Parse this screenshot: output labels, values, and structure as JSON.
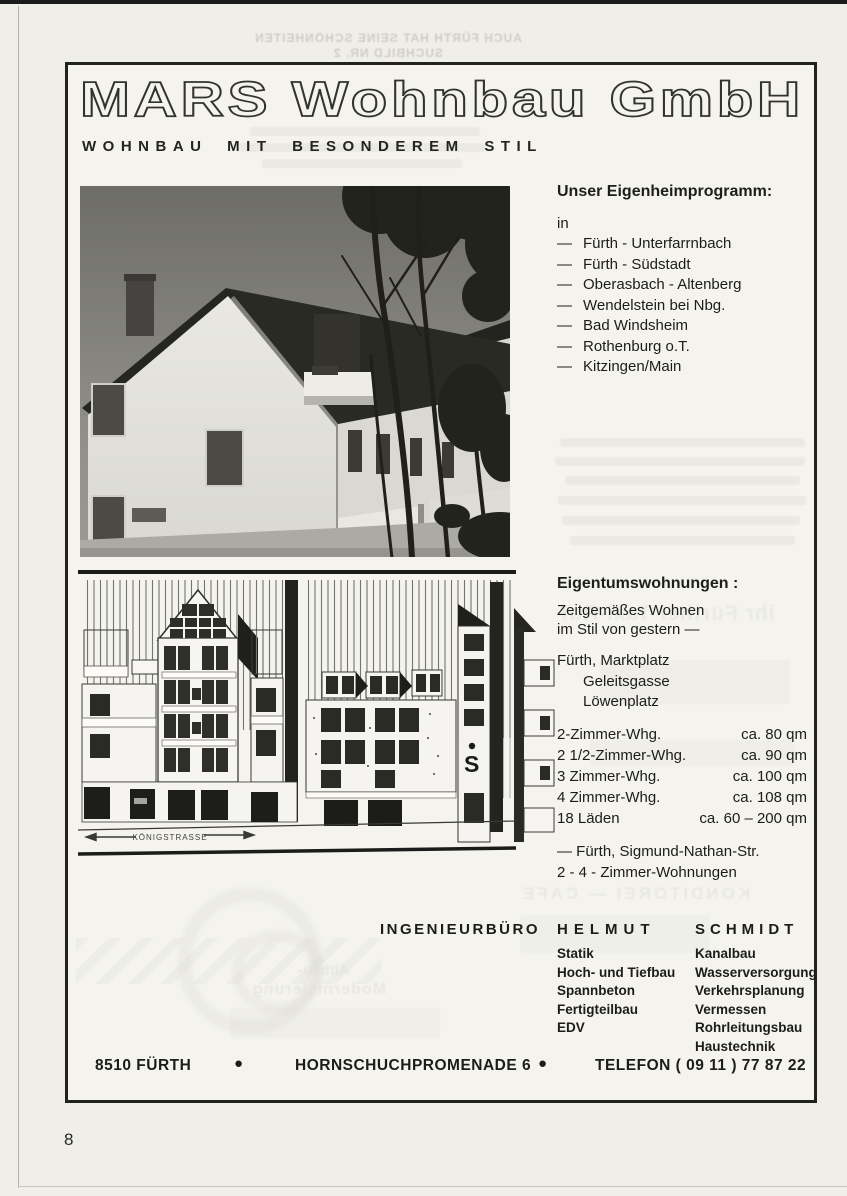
{
  "logo": {
    "text": "MARS Wohnbau GmbH"
  },
  "tagline": "WOHNBAU MIT BESONDEREM STIL",
  "program": {
    "heading": "Unser Eigenheimprogramm:",
    "intro": "in",
    "dash": "—",
    "locations": [
      "Fürth - Unterfarrnbach",
      "Fürth - Südstadt",
      "Oberasbach - Altenberg",
      "Wendelstein bei Nbg.",
      "Bad Windsheim",
      "Rothenburg o.T.",
      "Kitzingen/Main"
    ]
  },
  "condos": {
    "heading": "Eigentumswohnungen :",
    "slogan_line1": "Zeitgemäßes Wohnen",
    "slogan_line2": "im Stil von gestern —",
    "address_main": "Fürth, Marktplatz",
    "address_2": "Geleitsgasse",
    "address_3": "Löwenplatz",
    "units": [
      {
        "type": "2-Zimmer-Whg.",
        "size": "ca.   80 qm"
      },
      {
        "type": "2 1/2-Zimmer-Whg.",
        "size": "ca.   90 qm"
      },
      {
        "type": "3 Zimmer-Whg.",
        "size": "ca. 100 qm"
      },
      {
        "type": "4 Zimmer-Whg.",
        "size": "ca. 108 qm"
      },
      {
        "type": "18 Läden",
        "size": "ca. 60  –  200 qm"
      }
    ],
    "extra_line1": "— Fürth, Sigmund-Nathan-Str.",
    "extra_line2": "2 - 4 - Zimmer-Wohnungen"
  },
  "drawing": {
    "street_label": "KÖNIGSTRASSE",
    "sparkasse_s": "S"
  },
  "engineer": {
    "office_label": "INGENIEURBÜRO",
    "first_name": "HELMUT",
    "last_name": "SCHMIDT",
    "services_left": [
      "Statik",
      "Hoch- und Tiefbau",
      "Spannbeton",
      "Fertigteilbau",
      "EDV"
    ],
    "services_right": [
      "Kanalbau",
      "Wasserversorgung",
      "Verkehrsplanung",
      "Vermessen",
      "Rohrleitungsbau",
      "Haustechnik"
    ]
  },
  "footer": {
    "city": "8510 FÜRTH",
    "bullet": "●",
    "street": "HORNSCHUCHPROMENADE 6",
    "phone": "TELEFON ( 09 11 )  77 87 22"
  },
  "page": {
    "number": "8"
  },
  "ghosts": {
    "top_line1": "AUCH FÜRTH HAT SEINE SCHÖNHEITEN",
    "top_line2": "SUCHBILD NR. 2",
    "taxi": "ihr Fürther Taxi-Ruf",
    "konditorei": "KONDITOREI — CAFE",
    "altbau1": "Altbau-",
    "altbau2": "Modernisierung"
  }
}
